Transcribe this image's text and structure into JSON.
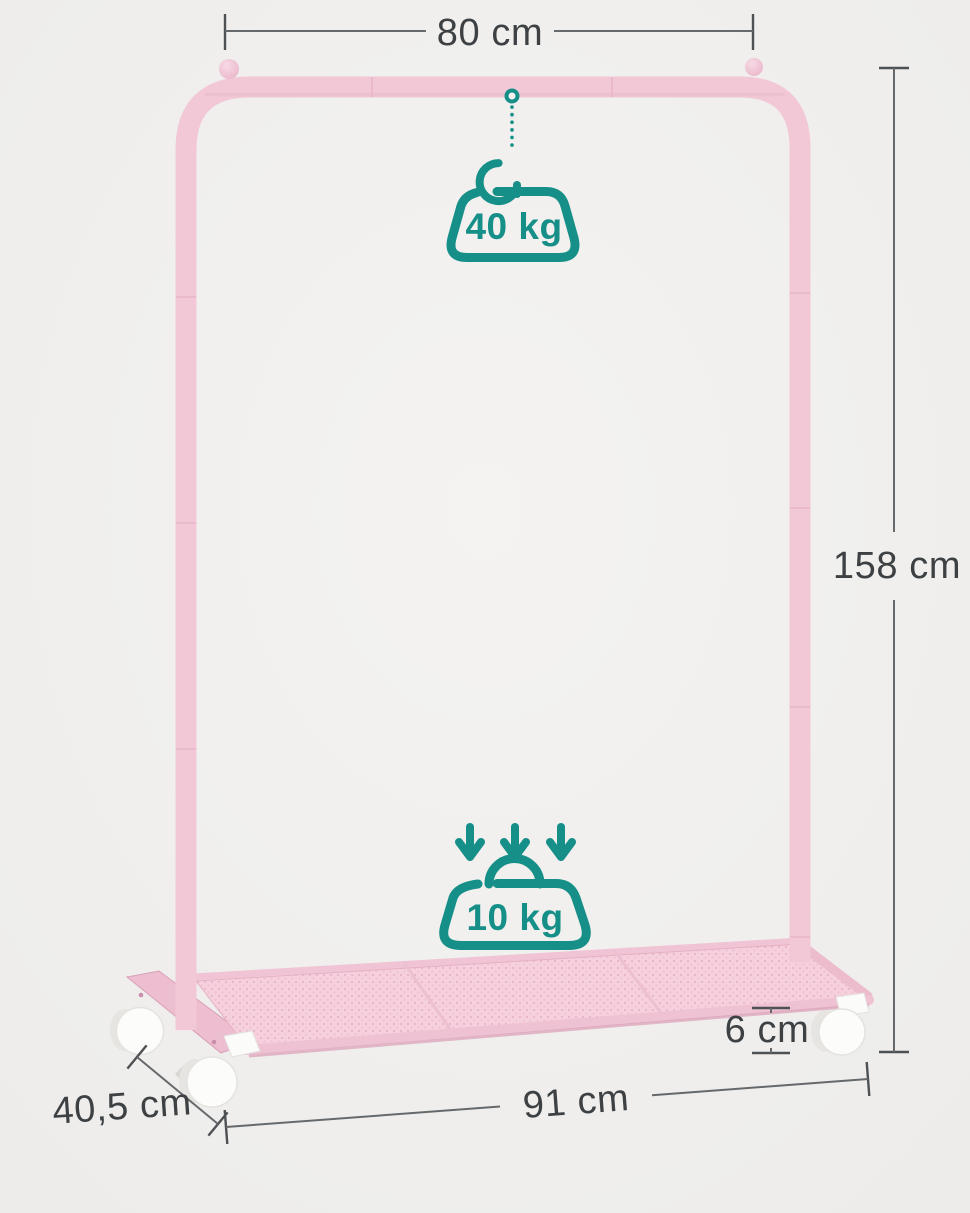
{
  "image": {
    "kind": "product-dimension-diagram",
    "subject": "pink garment rack on casters with bottom mesh shelf"
  },
  "dimensions": {
    "rail_width": {
      "label": "80 cm"
    },
    "total_height": {
      "label": "158 cm"
    },
    "shelf_clearance": {
      "label": "6 cm"
    },
    "base_width": {
      "label": "91 cm"
    },
    "base_depth": {
      "label": "40,5 cm"
    }
  },
  "capacities": {
    "hanging_rail": {
      "label": "40 kg"
    },
    "shelf": {
      "label": "10 kg"
    }
  },
  "icons": {
    "attach_ring": "ring-icon",
    "hanger": "hanger-hook-icon",
    "hanging_weight": "weight-icon",
    "load_arrows": "triple-down-arrow-icon",
    "shelf_weight": "weight-with-handle-icon"
  },
  "colors": {
    "background": "#f1f0ee",
    "frame_pink": "#f2c8d6",
    "frame_pink_shade": "#e2abc1",
    "mesh_pink": "#f6d0dd",
    "accent_teal": "#168f88",
    "dimension_line": "#66696c",
    "dimension_text": "#3d4144",
    "wheel_white": "#fcfcfa"
  }
}
